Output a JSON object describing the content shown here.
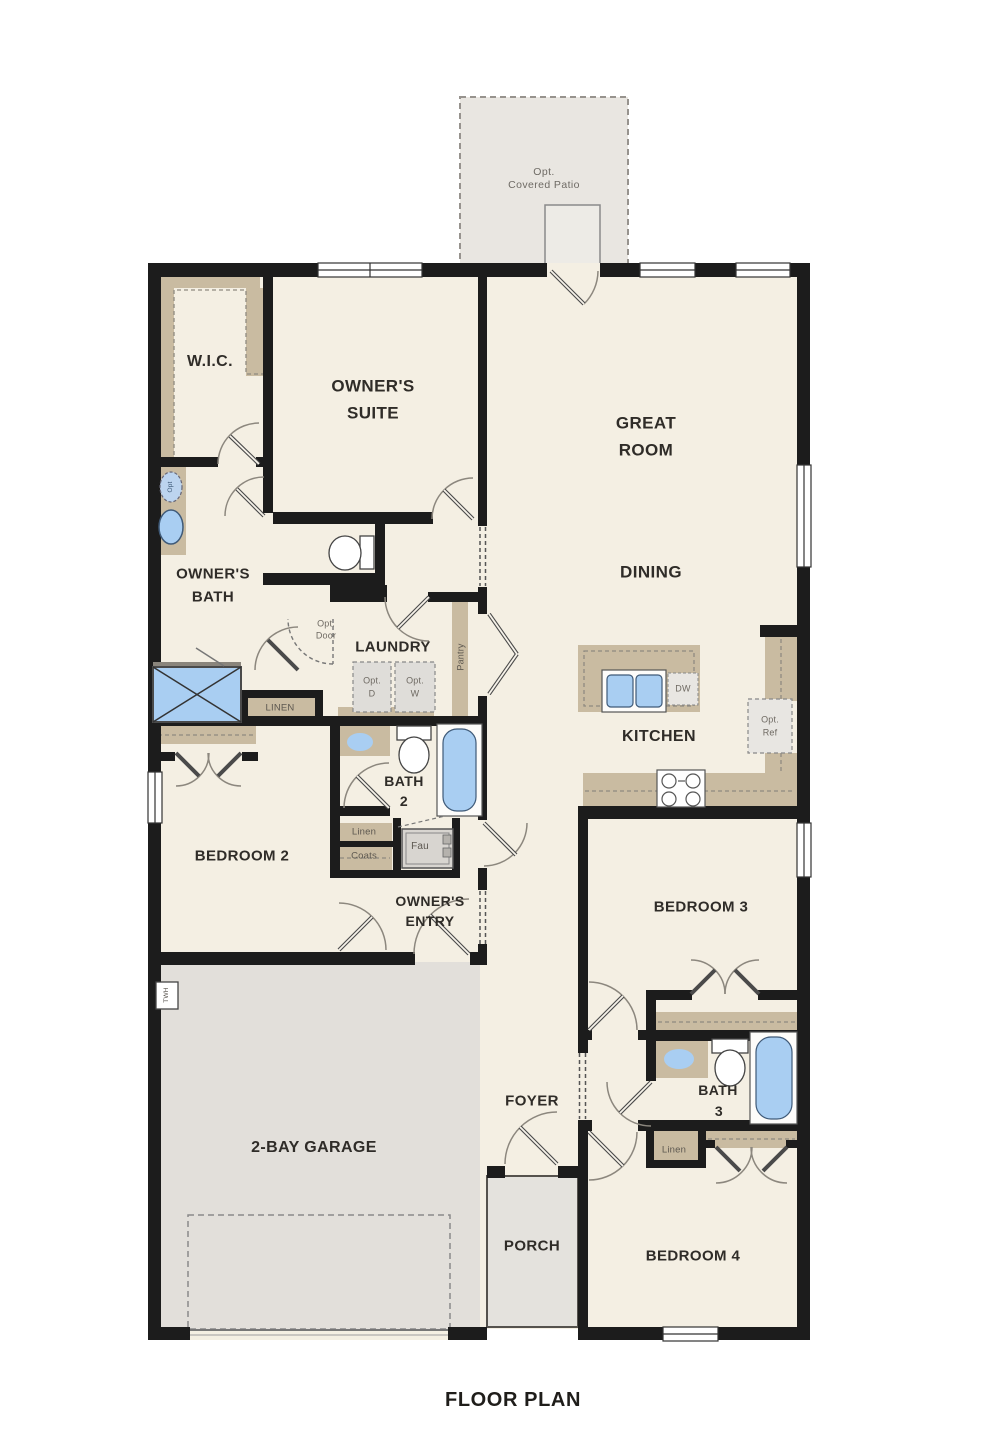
{
  "title": "FLOOR PLAN",
  "colors": {
    "wall": "#1c1c1c",
    "floor": "#f4efe3",
    "garage_floor": "#e2dfda",
    "porch_floor": "#e4e2dd",
    "patio_floor": "#e9e6e1",
    "counter_tan": "#c9bba1",
    "fixture_blue": "#a9cef2",
    "dashed_gray": "#8a8a8a"
  },
  "labels": {
    "patio_l1": "Opt.",
    "patio_l2": "Covered Patio",
    "wic": "W.I.C.",
    "owners_suite_l1": "OWNER'S",
    "owners_suite_l2": "SUITE",
    "great_room_l1": "GREAT",
    "great_room_l2": "ROOM",
    "dining": "DINING",
    "owners_bath_l1": "OWNER'S",
    "owners_bath_l2": "BATH",
    "laundry": "LAUNDRY",
    "pantry": "Pantry",
    "opt_door_l1": "Opt.",
    "opt_door_l2": "Door",
    "opt_d_l1": "Opt.",
    "opt_d_l2": "D",
    "opt_w_l1": "Opt.",
    "opt_w_l2": "W",
    "dw": "DW",
    "opt_ref_l1": "Opt.",
    "opt_ref_l2": "Ref",
    "kitchen": "KITCHEN",
    "linen_upper": "LINEN",
    "bath2_l1": "BATH",
    "bath2_l2": "2",
    "bedroom2": "BEDROOM 2",
    "linen_hall": "Linen",
    "coats": "Coats",
    "fau": "Fau",
    "owners_entry_l1": "OWNER'S",
    "owners_entry_l2": "ENTRY",
    "bedroom3": "BEDROOM 3",
    "foyer": "FOYER",
    "bath3_l1": "BATH",
    "bath3_l2": "3",
    "linen3": "Linen",
    "garage": "2-BAY GARAGE",
    "porch": "PORCH",
    "bedroom4": "BEDROOM 4",
    "twh": "TWH",
    "opt_sink": "Opt"
  }
}
